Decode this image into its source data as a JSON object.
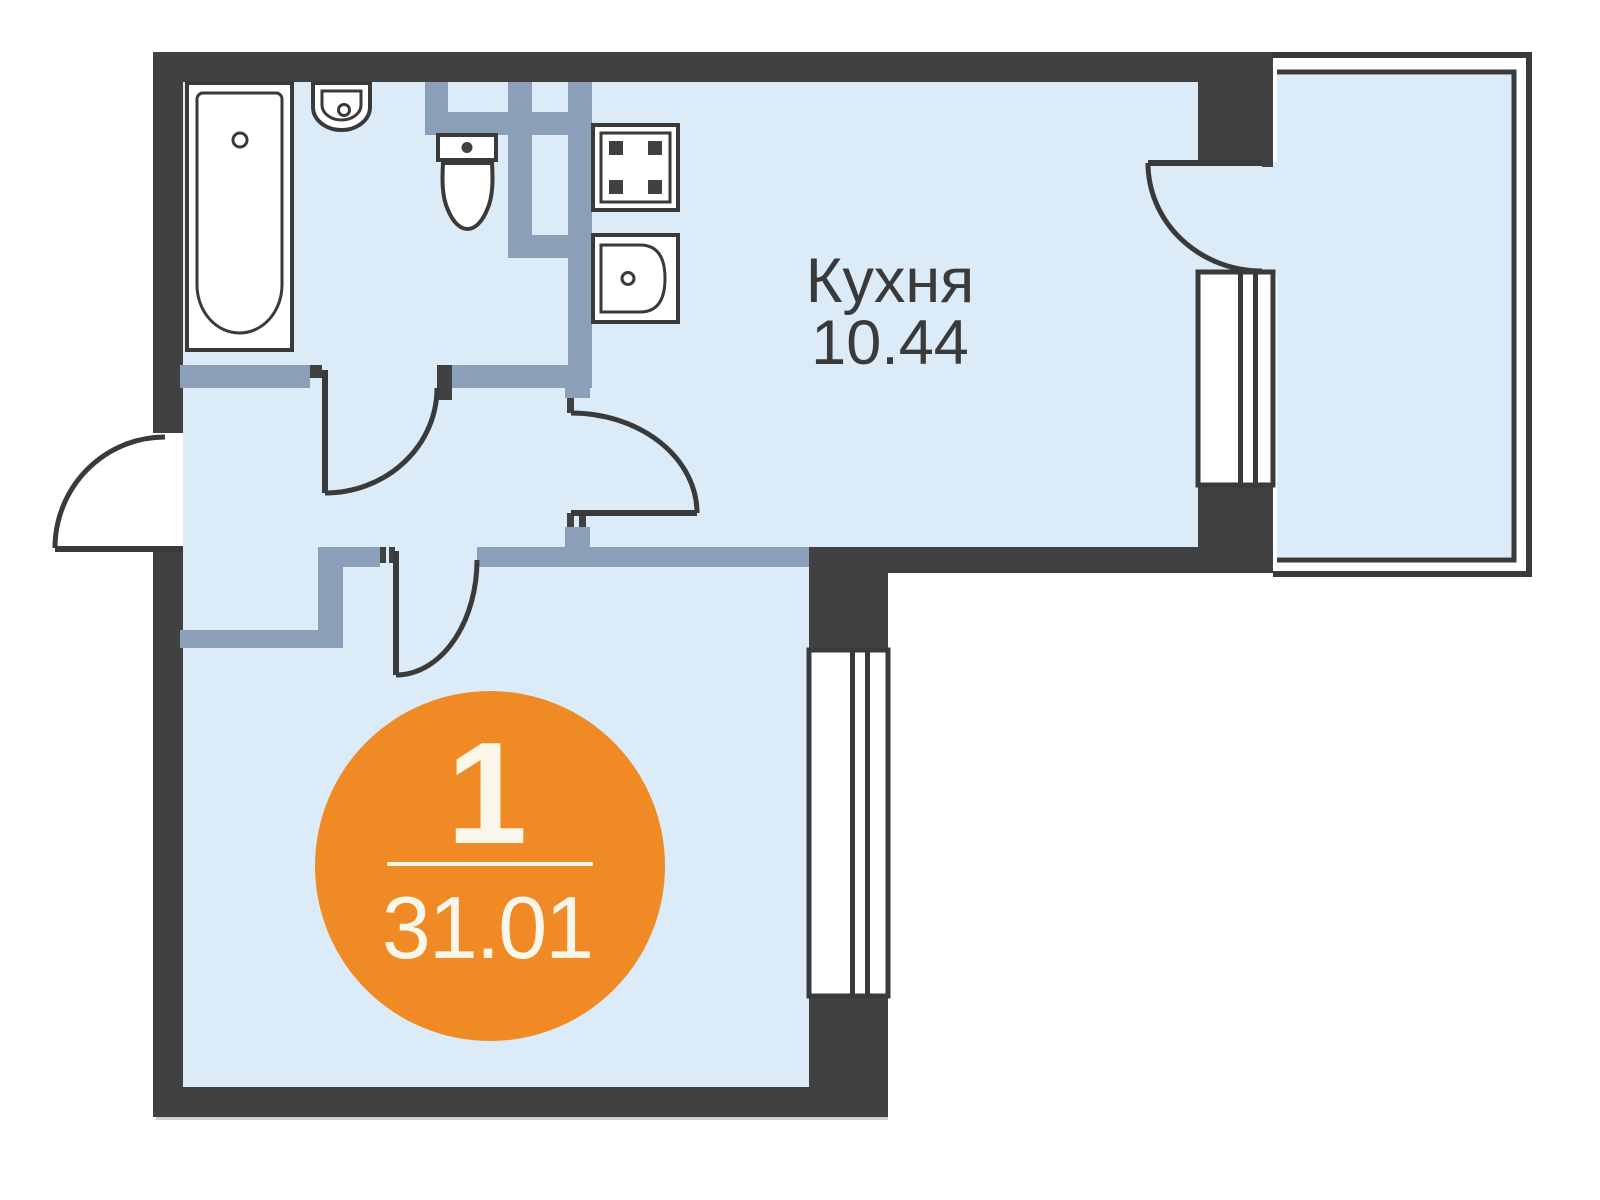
{
  "rooms": [
    {
      "name": "Кухня",
      "area": "10.44"
    }
  ],
  "badge": {
    "rooms": "1",
    "area": "31.01"
  },
  "fixtures": {
    "bathtub": "bathtub-icon",
    "washbasin": "washbasin-icon",
    "toilet": "toilet-icon",
    "stove": "stove-icon",
    "kitchen_sink": "kitchen-sink-icon"
  },
  "colors": {
    "wall": "#414141",
    "partition": "#8C9FB8",
    "floor": "#DCEBF8",
    "accent": "#EF8A25",
    "badgeText": "#FAF6E9",
    "line": "#3A3A3A",
    "white": "#FFFFFF",
    "shadow": "#CFCFCF"
  }
}
